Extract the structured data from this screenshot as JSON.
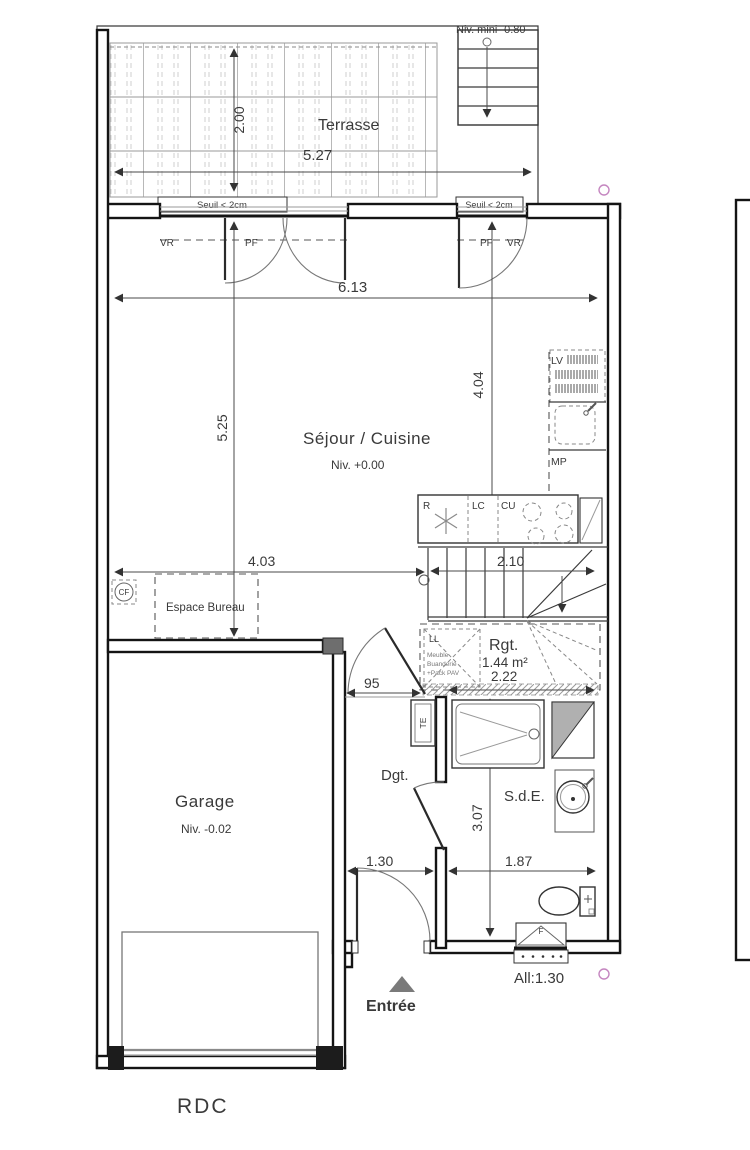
{
  "plan_title": "RDC",
  "colors": {
    "line": "#333333",
    "wall": "#141414",
    "marker_circle": "#c586c0",
    "shade": "#b0b0b0"
  },
  "labels": {
    "niv_mini": "Niv. mini -0.80",
    "terrasse": "Terrasse",
    "dim_terrasse_w": "5.27",
    "dim_terrasse_d": "2.00",
    "seuil_left": "Seuil < 2cm",
    "seuil_right": "Seuil < 2cm",
    "vr_left": "VR",
    "pf_left": "PF",
    "pf_right": "PF",
    "vr_right": "VR",
    "dim_sejour_w": "6.13",
    "dim_sejour_d": "5.25",
    "dim_kitchen_d": "4.04",
    "sejour": "Séjour / Cuisine",
    "sejour_niv": "Niv. +0.00",
    "lv": "LV",
    "mp": "MP",
    "r": "R",
    "lc": "LC",
    "cu": "CU",
    "dim_stairs": "2.10",
    "dim_bureau": "4.03",
    "cf": "CF",
    "espace_bureau": "Espace Bureau",
    "ll": "LL",
    "meuble_1": "Meuble",
    "meuble_2": "Buanderie",
    "meuble_3": "+Pack PAV",
    "rgt": "Rgt.",
    "rgt_area": "1.44 m²",
    "dim_rgt": "2.22",
    "dim_door": "95",
    "te": "TE",
    "garage": "Garage",
    "garage_niv": "Niv. -0.02",
    "dgt": "Dgt.",
    "sde": "S.d.E.",
    "dim_hall_w": "1.30",
    "dim_sde_w": "1.87",
    "dim_hall_d": "3.07",
    "entree": "Entrée",
    "allege": "All:1.30",
    "window_f": "F",
    "floor": "RDC"
  }
}
